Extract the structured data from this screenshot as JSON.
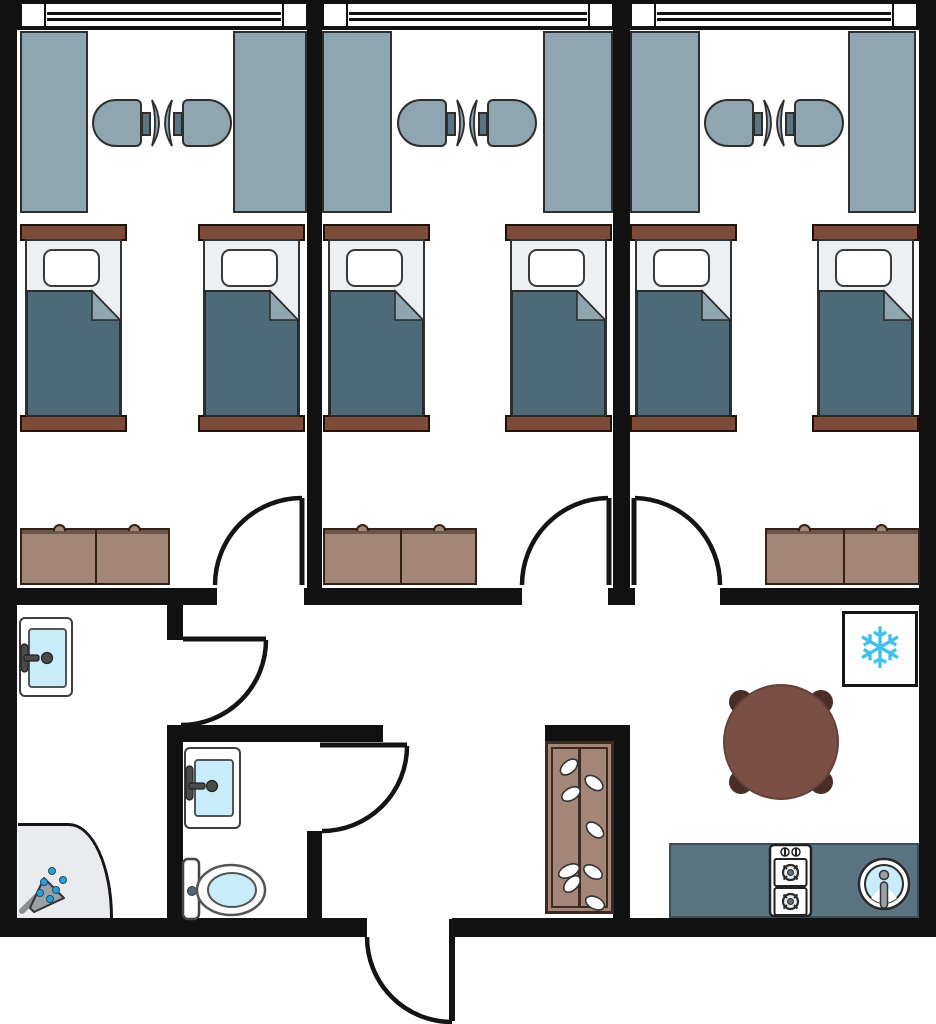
{
  "diagram": {
    "type": "floor-plan",
    "title": "Three-bedroom dormitory floor plan",
    "icons": {
      "snowflake": "❄"
    },
    "colors": {
      "wall": "#111111",
      "floor": "#ffffff",
      "furniture_gray": "#8fa5b0",
      "slate": "#5a7482",
      "blanket": "#4e6a78",
      "bed_linen": "#edf0f2",
      "wood": "#7c4b3a",
      "dresser": "#a48679",
      "dresser_trim": "#6b564c",
      "cabinet_border": "#3a2a22",
      "water": "#c9ecfa",
      "snowflake_blue": "#41c0f0",
      "drop_blue": "#2f9fd8",
      "table": "#7a5045",
      "table_leg": "#4a2d24",
      "shower_tray": "#e9ebee",
      "metal": "#9aa0a6",
      "faucet": "#4a4a4a"
    },
    "rooms": [
      {
        "name": "bedroom-1",
        "furniture": [
          "window",
          "desk x2",
          "chair x2",
          "single bed x2",
          "dresser",
          "door"
        ]
      },
      {
        "name": "bedroom-2",
        "furniture": [
          "window",
          "desk x2",
          "chair x2",
          "single bed x2",
          "dresser",
          "door"
        ]
      },
      {
        "name": "bedroom-3",
        "furniture": [
          "window",
          "desk x2",
          "chair x2",
          "single bed x2",
          "dresser",
          "door"
        ]
      },
      {
        "name": "washing-corridor",
        "furniture": [
          "sink",
          "corner shower"
        ]
      },
      {
        "name": "bathroom",
        "furniture": [
          "sink",
          "toilet",
          "door"
        ]
      },
      {
        "name": "entry-hall",
        "furniture": [
          "shoe cabinet",
          "entry door"
        ]
      },
      {
        "name": "kitchen-dining",
        "furniture": [
          "round dining table",
          "seat x4",
          "refrigerator",
          "counter",
          "two-burner stove",
          "round sink"
        ]
      }
    ]
  }
}
